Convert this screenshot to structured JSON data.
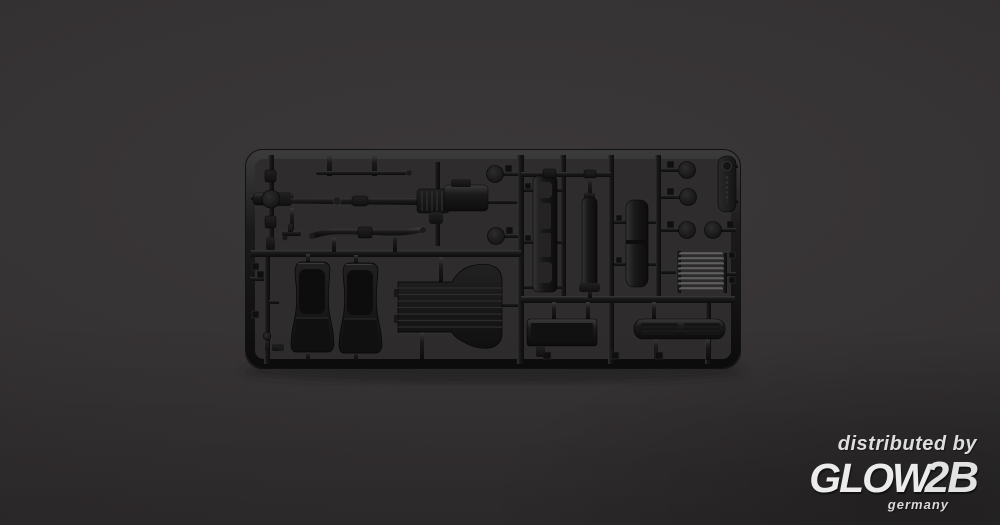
{
  "watermark": {
    "line1": "distributed by",
    "brand_glow": "GLOW",
    "brand_2b": "2B",
    "sub": "germany"
  },
  "colors": {
    "background": "#363334",
    "background_edge": "#2a2728",
    "sprue_plastic": "#141414",
    "plastic_highlight": "#3e3e3e",
    "rod_highlight": "#7d7d7d",
    "watermark_text": "#e6e6e6"
  },
  "sprue": {
    "material": "black styrene plastic",
    "parts": [
      {
        "name": "front-axle-assembly",
        "count": 1
      },
      {
        "name": "drive-shaft",
        "count": 1
      },
      {
        "name": "gearbox-assembly",
        "count": 1
      },
      {
        "name": "tie-rod",
        "count": 1
      },
      {
        "name": "leaf-spring",
        "count": 1
      },
      {
        "name": "bucket-seat",
        "count": 2
      },
      {
        "name": "ribbed-floor-pan",
        "count": 1
      },
      {
        "name": "ladder-frame",
        "count": 1
      },
      {
        "name": "frame-rail",
        "count": 1
      },
      {
        "name": "fuel-tank",
        "count": 1
      },
      {
        "name": "wheel-disc",
        "count": 6
      },
      {
        "name": "rod-bundle",
        "count": 1
      },
      {
        "name": "storage-box",
        "count": 1
      },
      {
        "name": "running-board",
        "count": 1
      },
      {
        "name": "molded-info-tab",
        "count": 1
      }
    ]
  }
}
